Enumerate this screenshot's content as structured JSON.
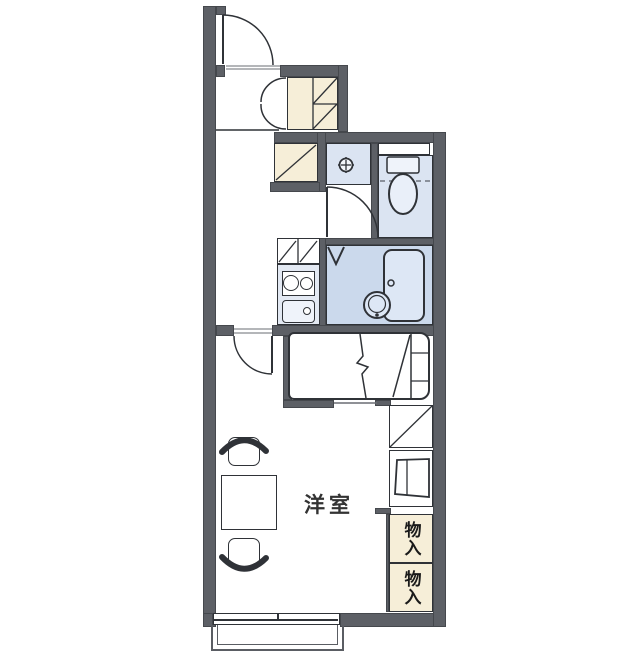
{
  "plan": {
    "type": "apartment-floorplan-1K",
    "room_label": "洋室",
    "storage_labels": [
      "物入",
      "物入"
    ],
    "colors": {
      "wall": "#5d6066",
      "line": "#2f3237",
      "cream": "#f6eed8",
      "blue": "#dbe4f2",
      "bathblue": "#cbd9ec",
      "fixture": "#eff3fa",
      "panel": "#e3e9f3",
      "tub": "#dde7f5",
      "dash": "#8a909b",
      "balcony": "#5a5d63",
      "text": "#333333"
    },
    "fixtures": [
      "entrance-door",
      "shoe-cabinet",
      "closet",
      "washing-machine-pan",
      "toilet",
      "bathtub",
      "wash-basin",
      "kitchen-stove",
      "kitchen-sink",
      "range-hood-shelf",
      "refrigerator-space",
      "cabinet",
      "bed",
      "table",
      "chair",
      "chair",
      "sliding-window",
      "balcony"
    ]
  }
}
